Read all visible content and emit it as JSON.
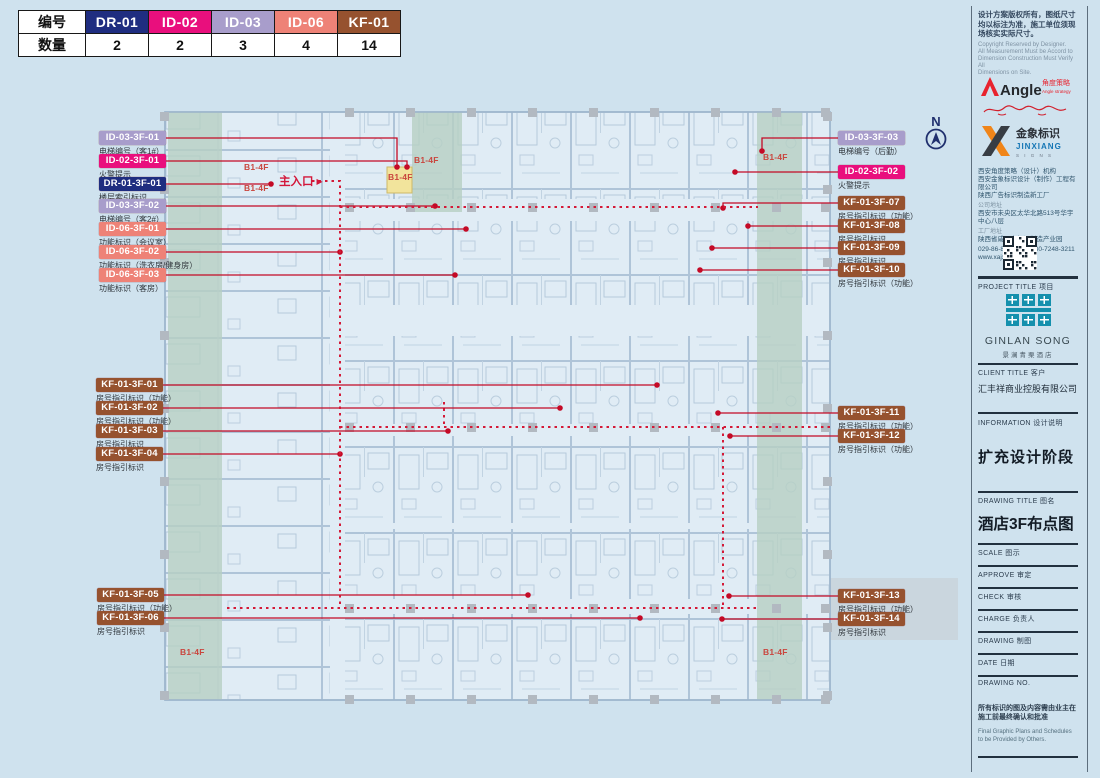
{
  "legend": {
    "row1_label": "编号",
    "row2_label": "数量",
    "items": [
      {
        "code": "DR-01",
        "count": "2",
        "color": "#1f2d80"
      },
      {
        "code": "ID-02",
        "count": "2",
        "color": "#e90f7d"
      },
      {
        "code": "ID-03",
        "count": "3",
        "color": "#a89dcb"
      },
      {
        "code": "ID-06",
        "count": "4",
        "color": "#ee8277"
      },
      {
        "code": "KF-01",
        "count": "14",
        "color": "#96522f"
      }
    ]
  },
  "plan": {
    "entrance_label": "主入口",
    "entrance_arrow": "▶",
    "north_label": "N",
    "floor_tag": "B1-4F"
  },
  "callouts": [
    {
      "code": "ID-03-3F-01",
      "type": "ID-03",
      "desc": "电梯编号（客1#）"
    },
    {
      "code": "ID-02-3F-01",
      "type": "ID-02",
      "desc": "火警提示"
    },
    {
      "code": "DR-01-3F-01",
      "type": "DR-01",
      "desc": "楼层索引标识"
    },
    {
      "code": "ID-03-3F-02",
      "type": "ID-03",
      "desc": "电梯编号（客2#）"
    },
    {
      "code": "ID-06-3F-01",
      "type": "ID-06",
      "desc": "功能标识（会议室）"
    },
    {
      "code": "ID-06-3F-02",
      "type": "ID-06",
      "desc": "功能标识（洗衣房/健身房）"
    },
    {
      "code": "ID-06-3F-03",
      "type": "ID-06",
      "desc": "功能标识（客房）"
    },
    {
      "code": "KF-01-3F-01",
      "type": "KF-01",
      "desc": "房号指引标识（功能）"
    },
    {
      "code": "KF-01-3F-02",
      "type": "KF-01",
      "desc": "房号指引标识（功能）"
    },
    {
      "code": "KF-01-3F-03",
      "type": "KF-01",
      "desc": "房号指引标识"
    },
    {
      "code": "KF-01-3F-04",
      "type": "KF-01",
      "desc": "房号指引标识"
    },
    {
      "code": "KF-01-3F-05",
      "type": "KF-01",
      "desc": "房号指引标识（功能）"
    },
    {
      "code": "KF-01-3F-06",
      "type": "KF-01",
      "desc": "房号指引标识"
    },
    {
      "code": "ID-03-3F-03",
      "type": "ID-03",
      "desc": "电梯编号（后勤）"
    },
    {
      "code": "ID-02-3F-02",
      "type": "ID-02",
      "desc": "火警提示"
    },
    {
      "code": "KF-01-3F-07",
      "type": "KF-01",
      "desc": "房号指引标识（功能）"
    },
    {
      "code": "KF-01-3F-08",
      "type": "KF-01",
      "desc": "房号指引标识"
    },
    {
      "code": "KF-01-3F-09",
      "type": "KF-01",
      "desc": "房号指引标识"
    },
    {
      "code": "KF-01-3F-10",
      "type": "KF-01",
      "desc": "房号指引标识（功能）"
    },
    {
      "code": "KF-01-3F-11",
      "type": "KF-01",
      "desc": "房号指引标识（功能）"
    },
    {
      "code": "KF-01-3F-12",
      "type": "KF-01",
      "desc": "房号指引标识（功能）"
    },
    {
      "code": "KF-01-3F-13",
      "type": "KF-01",
      "desc": "房号指引标识（功能）"
    },
    {
      "code": "KF-01-3F-14",
      "type": "KF-01",
      "desc": "房号指引标识"
    }
  ],
  "sidebar": {
    "note_zh": "设计方案版权所有，图纸尺寸均以标注为准，施工单位须现场核实实际尺寸。",
    "note_en_lines": [
      "Copyright Reserved by Designer.",
      "All Measurement Must be Accord to",
      "Dimension Construction Must Verify All",
      "Dimensions on Site."
    ],
    "angle_logo": {
      "name": "Angle",
      "zh": "角度策略",
      "en": "Angle strategy"
    },
    "jinxiang_logo": {
      "zh": "金象标识",
      "en": "JINXIANG",
      "sub": "S I G N S"
    },
    "company_lines": [
      "西安角度策略（设计）机构",
      "西安金象标识设计（制作）工程有限公司",
      "陕西广告标识制造新工厂"
    ],
    "address_label1": "公司地址",
    "address1": "西安市未央区太华北路513号华宇中心八层",
    "address_label2": "工厂地址",
    "address2": "陕西省咸阳市标识制造产业园",
    "phone": "029-86-86185003 130-7248-3211",
    "website": "www.xajxad.com",
    "project_title": "PROJECT TITLE 项目",
    "brand": {
      "name": "GINLAN SONG",
      "zh": "景澜青栗酒店"
    },
    "client_title": "CLIENT TITLE 客户",
    "client_name": "汇丰祥商业控股有限公司",
    "information_title": "INFORMATION 设计说明",
    "information_value": "扩充设计阶段",
    "drawing_title_label": "DRAWING TITLE 图名",
    "drawing_title_value": "酒店3F布点图",
    "fields": [
      "SCALE 图示",
      "APPROVE 审定",
      "CHECK 审核",
      "CHARGE 负责人",
      "DRAWING 制图",
      "DATE 日期",
      "DRAWING NO."
    ],
    "footer_zh": "所有标识的图及内容需由业主在施工前最终确认和批准",
    "footer_en": "Final Graphic Plans and Schedules to be Provided by Others."
  }
}
